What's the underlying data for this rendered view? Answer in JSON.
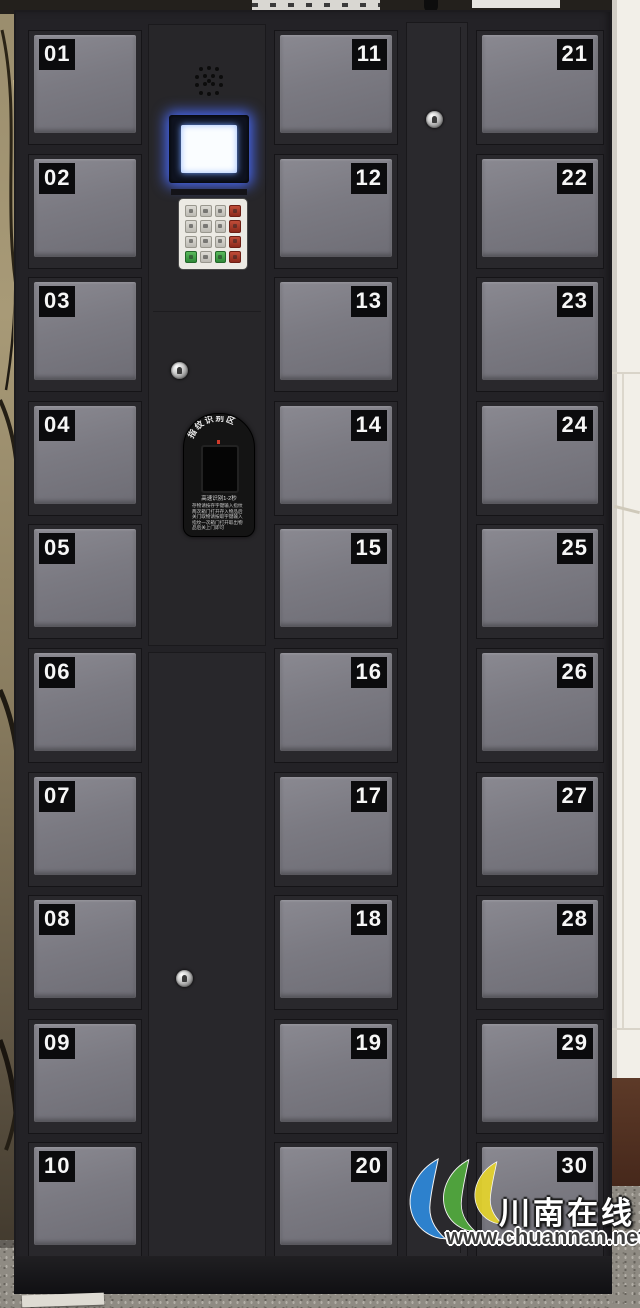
{
  "lockers": {
    "left": [
      "01",
      "02",
      "03",
      "04",
      "05",
      "06",
      "07",
      "08",
      "09",
      "10"
    ],
    "middle": [
      "11",
      "12",
      "13",
      "14",
      "15",
      "16",
      "17",
      "18",
      "19",
      "20"
    ],
    "right": [
      "21",
      "22",
      "23",
      "24",
      "25",
      "26",
      "27",
      "28",
      "29",
      "30"
    ]
  },
  "control_panel": {
    "screen_state": "on",
    "screen_glow_color": "#4a6cff",
    "keypad_rows": [
      [
        "gray",
        "gray",
        "gray",
        "red"
      ],
      [
        "gray",
        "gray",
        "gray",
        "red"
      ],
      [
        "gray",
        "gray",
        "gray",
        "red"
      ],
      [
        "green",
        "gray",
        "green",
        "red"
      ]
    ],
    "fingerprint": {
      "title": "指纹识别区",
      "subtitle": "高速识别1-2秒",
      "instructions": [
        "存物请按存字键输入指纹",
        "两次箱门打开存入物品后",
        "关门取物请按取字键输入",
        "指纹一次箱门打开取出物",
        "品后关上门即可"
      ]
    }
  },
  "watermark": {
    "site_name": "川南在线",
    "site_url": "www.chuannan.net"
  },
  "colors": {
    "cabinet_frame": "#232226",
    "door_face": "#29282c",
    "door_panel": "#7b7a82",
    "label_bg": "#0b0b0d",
    "logo_blue": "#2e86d6",
    "logo_green": "#52a83e",
    "logo_yellow": "#e3d22f"
  }
}
